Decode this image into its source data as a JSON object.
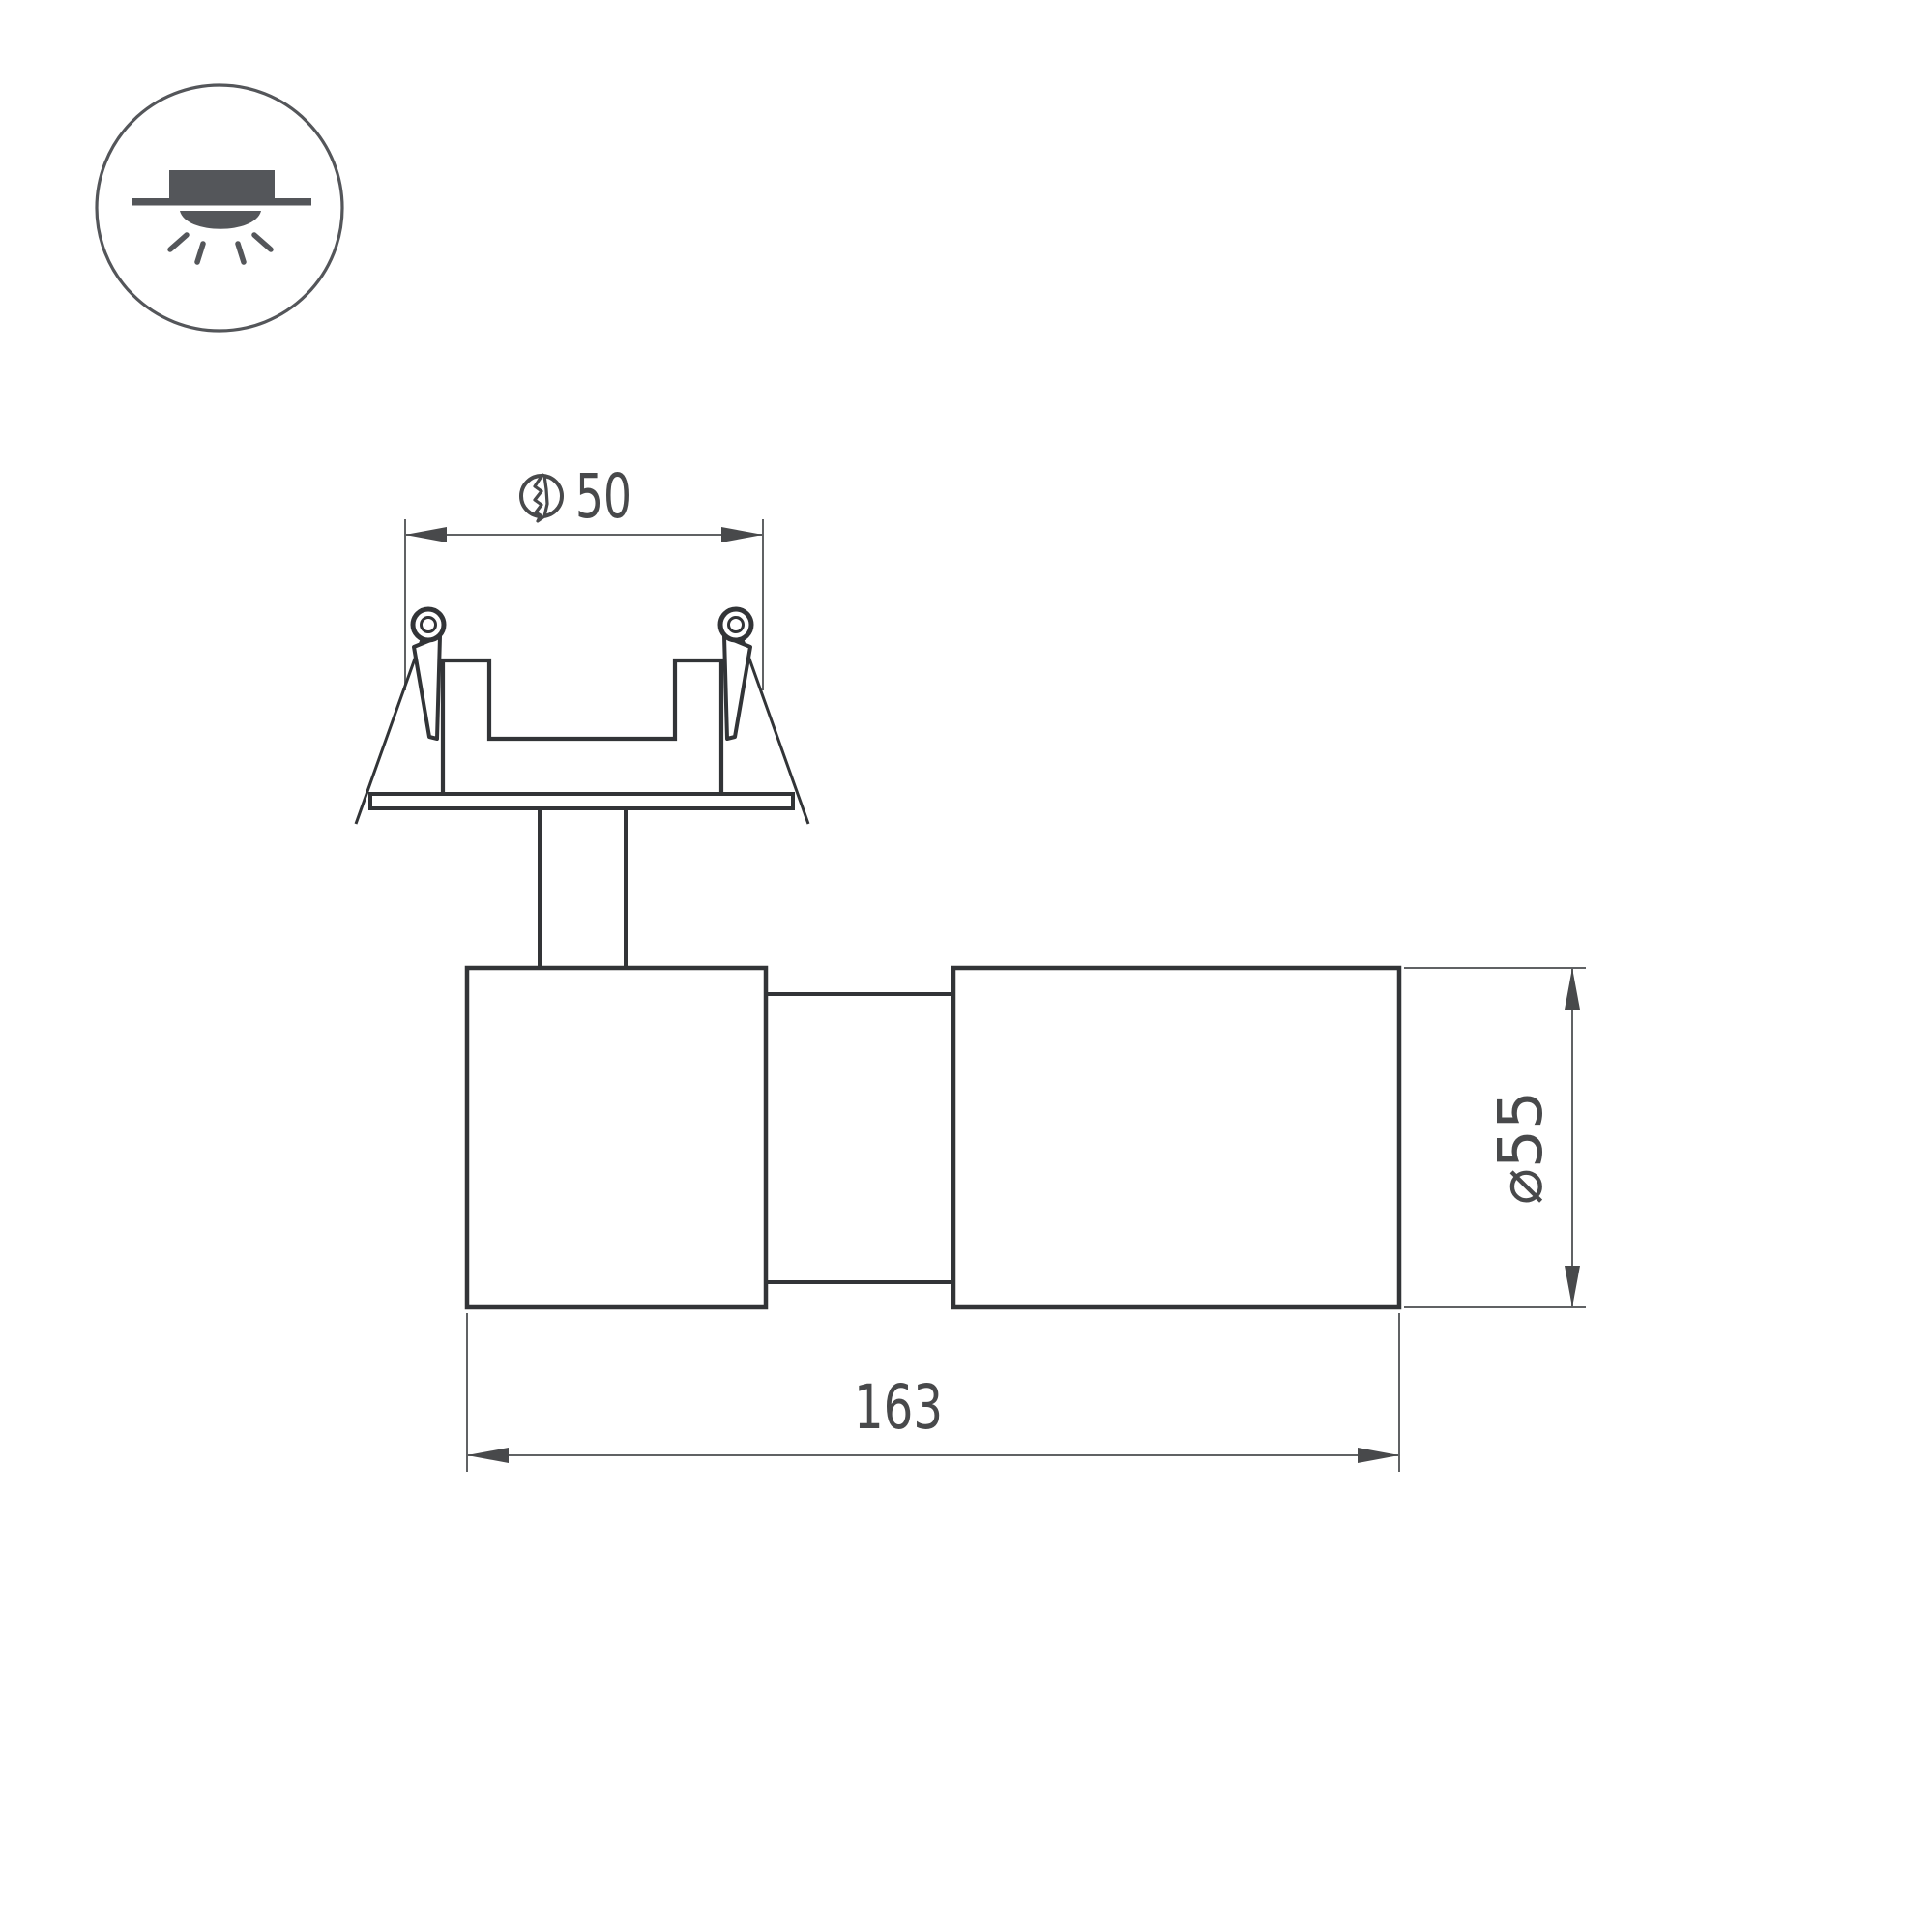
{
  "title": "Recessed spotlight technical drawing",
  "icon": {
    "type": "recessed-downlight-symbol",
    "description": "circle badge with recessed fixture above ceiling line, light dome and 4 rays"
  },
  "dimensions": {
    "hole": {
      "value": "50",
      "symbol": "mounting-hole-diameter",
      "unit": "mm"
    },
    "diameter": {
      "value": "⌀55",
      "unit": "mm"
    },
    "length": {
      "value": "163",
      "unit": "mm"
    }
  },
  "colors": {
    "background": "#ffffff",
    "outline": "#323437",
    "thin_line": "#606264",
    "arrow_and_text": "#48494b",
    "icon_gray": "#54565a"
  }
}
